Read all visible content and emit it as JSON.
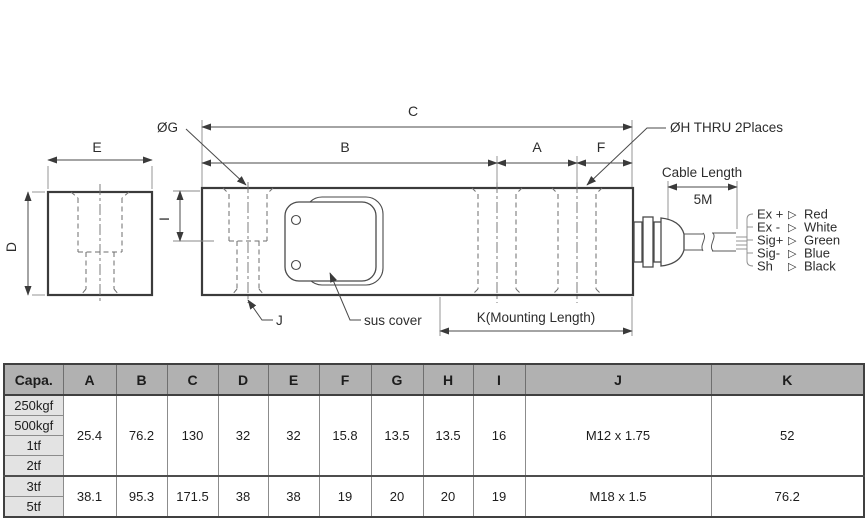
{
  "drawing": {
    "dims": {
      "c": "C",
      "b": "B",
      "a": "A",
      "f": "F",
      "e": "E",
      "d": "D",
      "i": "I"
    },
    "labels": {
      "hole_g": "ØG",
      "hole_h": "ØH THRU 2Places",
      "cable_length": "Cable Length",
      "cable_length_value": "5M",
      "thread": "J",
      "sus_cover": "sus cover",
      "mounting": "K(Mounting Length)"
    },
    "wiring": {
      "arrow": "▷",
      "rows": [
        {
          "signal": "Ex +",
          "color": "Red"
        },
        {
          "signal": "Ex -",
          "color": "White"
        },
        {
          "signal": "Sig+",
          "color": "Green"
        },
        {
          "signal": "Sig-",
          "color": "Blue"
        },
        {
          "signal": "Sh",
          "color": "Black"
        }
      ]
    }
  },
  "table": {
    "header": [
      "Capa.",
      "A",
      "B",
      "C",
      "D",
      "E",
      "F",
      "G",
      "H",
      "I",
      "J",
      "K"
    ],
    "groups": [
      {
        "capacities": [
          "250kgf",
          "500kgf",
          "1tf",
          "2tf"
        ],
        "values": [
          "25.4",
          "76.2",
          "130",
          "32",
          "32",
          "15.8",
          "13.5",
          "13.5",
          "16",
          "M12 x 1.75",
          "52"
        ]
      },
      {
        "capacities": [
          "3tf",
          "5tf"
        ],
        "values": [
          "38.1",
          "95.3",
          "171.5",
          "38",
          "38",
          "19",
          "20",
          "20",
          "19",
          "M18 x 1.5",
          "76.2"
        ]
      }
    ]
  },
  "colors": {
    "line": "#3b3b3b",
    "table_header_bg": "#b1b1b1",
    "capacity_cell_bg": "#e3e3e3"
  }
}
